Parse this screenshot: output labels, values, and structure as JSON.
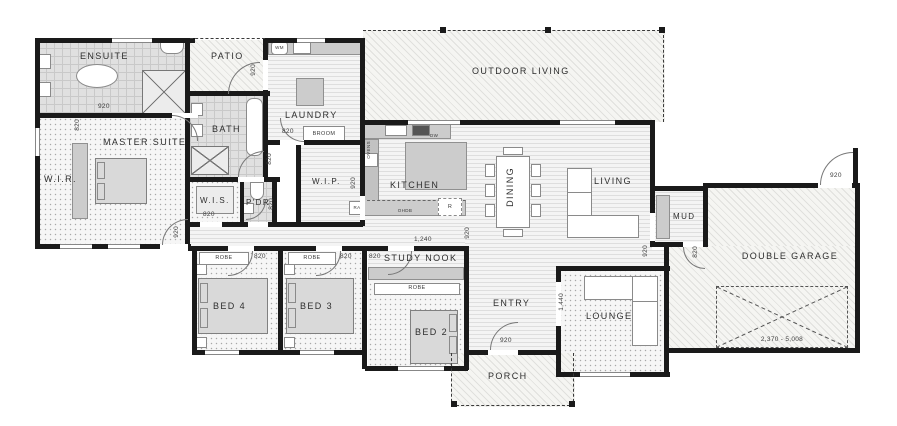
{
  "rooms": {
    "ensuite": "ENSUITE",
    "patio": "PATIO",
    "outdoor_living": "OUTDOOR LIVING",
    "laundry": "LAUNDRY",
    "bath": "BATH",
    "master_suite": "MASTER SUITE",
    "wir": "W.I.R.",
    "wis": "W.I.S.",
    "pdr": "P'DR",
    "wip": "W.I.P.",
    "kitchen": "KITCHEN",
    "dining": "DINING",
    "living": "LIVING",
    "mud": "MUD",
    "double_garage": "DOUBLE GARAGE",
    "study_nook": "STUDY NOOK",
    "bed2": "BED 2",
    "bed3": "BED 3",
    "bed4": "BED 4",
    "entry": "ENTRY",
    "lounge": "LOUNGE",
    "porch": "PORCH"
  },
  "dims": {
    "w920": "920",
    "w820": "820",
    "nook_width": "1,240",
    "lounge_opening": "1,440",
    "garage_clearance": "2,370 - 5,008"
  },
  "fixtures": {
    "robe": "ROBE",
    "broom": "BROOM",
    "washing_machine": "WM",
    "dishwasher": "DW",
    "ovens": "OVENS",
    "overhead_cupboards": "OHDB",
    "return_air": "RA",
    "fridge": "R"
  },
  "colors": {
    "wall": "#1a1a1a",
    "label": "#2e2e2e",
    "dimension": "#3d3d3d",
    "bench": "#cccccc",
    "carpet": "#f6f6f6",
    "tile": "#e0e0e0"
  }
}
